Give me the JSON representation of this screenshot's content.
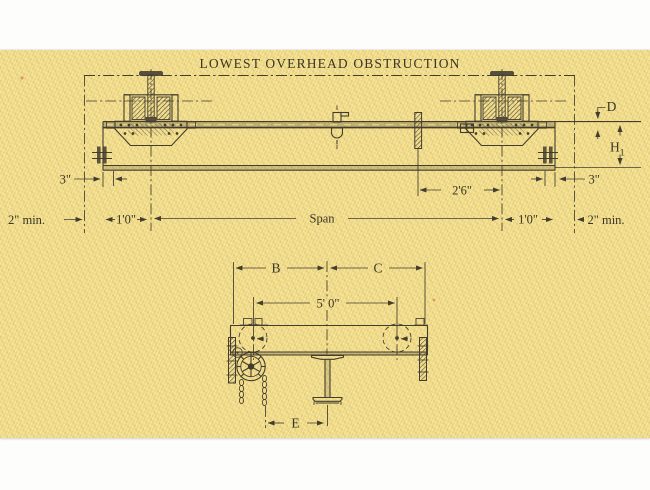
{
  "document": {
    "kind": "scanned engineering drawing, underhung crane dimension diagram",
    "colors": {
      "paper": "#f2dc84",
      "ink": "#433d2e",
      "margin": "#fdfdfb",
      "speck": "#c4604a"
    }
  },
  "top_view": {
    "title": "LOWEST OVERHEAD OBSTRUCTION",
    "dim_left_3": "3\"",
    "dim_left_2min": "2\" min.",
    "dim_left_1ft": "1'0\"",
    "dim_span": "Span",
    "dim_2ft6": "2'6\"",
    "dim_right_1ft": "1'0\"",
    "dim_right_3": "3\"",
    "dim_right_2min": "2\" min.",
    "dim_depth": "D",
    "dim_headroom_main": "H",
    "dim_headroom_sub": "1"
  },
  "end_view": {
    "dim_b": "B",
    "dim_c": "C",
    "dim_5ft": "5' 0\"",
    "dim_e": "E"
  }
}
